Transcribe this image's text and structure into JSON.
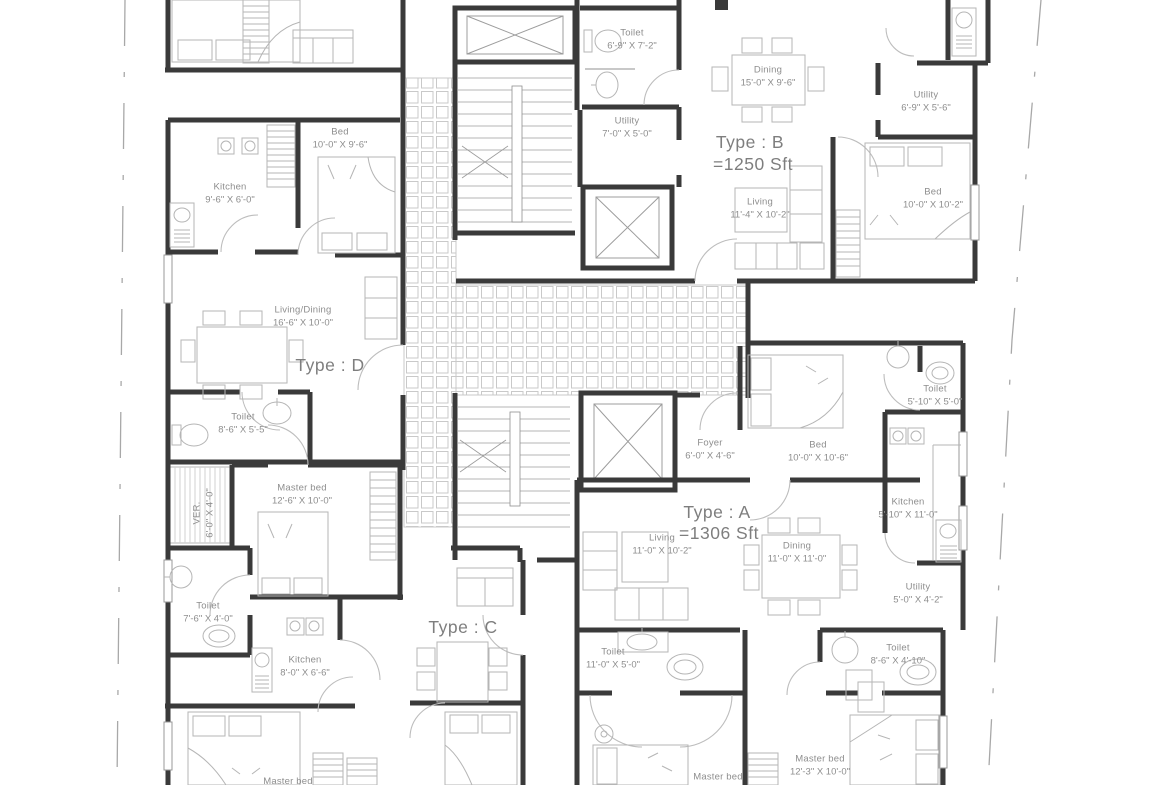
{
  "title": "Apartment typical floor plan",
  "colors": {
    "wall": "#3a3a3a",
    "furniture": "#b5b5b5",
    "tile": "#cccccc",
    "label": "#8e8e8e",
    "boundary": "#a8a8a8"
  },
  "types": [
    {
      "label": "Type : B",
      "area": "=1250 Sft"
    },
    {
      "label": "Type : D",
      "area": ""
    },
    {
      "label": "Type : A",
      "area": "=1306 Sft"
    },
    {
      "label": "Type : C",
      "area": ""
    }
  ],
  "rooms": [
    {
      "name": "Toilet",
      "dims": "6'-9\" X 7'-2\""
    },
    {
      "name": "Dining",
      "dims": "15'-0\" X 9'-6\""
    },
    {
      "name": "Utility",
      "dims": "6'-9\" X 5'-6\""
    },
    {
      "name": "Utility",
      "dims": "7'-0\" X 5'-0\""
    },
    {
      "name": "Living",
      "dims": "11'-4\" X 10'-2\""
    },
    {
      "name": "Bed",
      "dims": "10'-0\" X 10'-2\""
    },
    {
      "name": "Bed",
      "dims": "10'-0\" X 9'-6\""
    },
    {
      "name": "Kitchen",
      "dims": "9'-6\" X 6'-0\""
    },
    {
      "name": "Living/Dining",
      "dims": "16'-6\" X 10'-0\""
    },
    {
      "name": "Toilet",
      "dims": "8'-6\" X 5'-5\""
    },
    {
      "name": "Master bed",
      "dims": "12'-6\" X 10'-0\""
    },
    {
      "name": "VER.",
      "dims": "6'-0\" X 4'-0\""
    },
    {
      "name": "Toilet",
      "dims": "7'-6\" X 4'-0\""
    },
    {
      "name": "Kitchen",
      "dims": "8'-0\" X 6'-6\""
    },
    {
      "name": "Master bed",
      "dims": ""
    },
    {
      "name": "Foyer",
      "dims": "6'-0\" X 4'-6\""
    },
    {
      "name": "Bed",
      "dims": "10'-0\" X 10'-6\""
    },
    {
      "name": "Toilet",
      "dims": "5'-10\" X 5'-0\""
    },
    {
      "name": "Kitchen",
      "dims": "5'-10\" X 11'-0\""
    },
    {
      "name": "Living",
      "dims": "11'-0\" X 10'-2\""
    },
    {
      "name": "Dining",
      "dims": "11'-0\" X 11'-0\""
    },
    {
      "name": "Utility",
      "dims": "5'-0\" X 4'-2\""
    },
    {
      "name": "Toilet",
      "dims": "11'-0\" X 5'-0\""
    },
    {
      "name": "Toilet",
      "dims": "8'-6\" X 4'-10\""
    },
    {
      "name": "Master bed",
      "dims": "11'-0\" X 10'-6\""
    },
    {
      "name": "Master bed",
      "dims": "12'-3\" X 10'-0\""
    }
  ]
}
